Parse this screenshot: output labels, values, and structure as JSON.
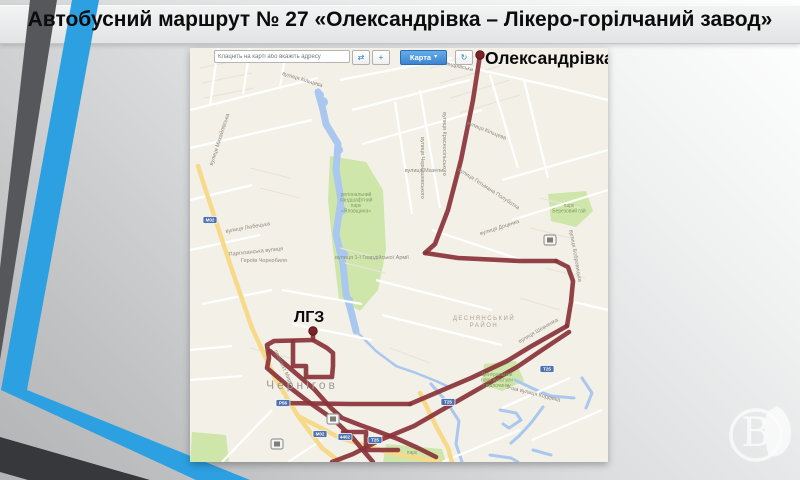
{
  "slide": {
    "title": "Автобусний маршрут № 27 «Олександрівка – Лікеро-горілчаний завод»",
    "watermark_letter": "В"
  },
  "toolbar": {
    "search_placeholder": "Клацніть на карті або вкажіть адресу",
    "map_button": "Карта",
    "icons": {
      "swap": "⇄",
      "pan": "+",
      "dropdown": "▾",
      "refresh": "↻"
    }
  },
  "route_labels": {
    "start": "Олександрівка",
    "end": "ЛГЗ"
  },
  "map": {
    "city": "Чернігов",
    "district": [
      "ДЕСНЯНСЬКИЙ",
      "РАЙОН"
    ],
    "colors": {
      "route": "#8a3338",
      "route_dot": "#7c2325",
      "water": "#a9c7ef",
      "park": "#cfe6ab",
      "road_major": "#f6da89",
      "map_bg": "#f3f0e8",
      "shield": "#5072b0",
      "street_label": "#8f8a80",
      "park_label": "#7f9f5f",
      "city_label": "#9b9b9b",
      "district_label": "#a9a39b",
      "white_road": "#ffffff",
      "minor_road": "#e9e4d7",
      "stripe_blue": "#2da0e2",
      "stripe_dark": "#55575a",
      "stripe_dark2": "#36383b"
    },
    "stripes": [
      {
        "fill": "#55575a",
        "pts": "30,0 57,0 0,360 0,268"
      },
      {
        "fill": "#2da0e2",
        "pts": "72,0 99,0 27,390 1,390"
      },
      {
        "fill": "#2da0e2",
        "pts": "1,390 27,390 250,480 196,480"
      },
      {
        "fill": "#36383b",
        "pts": "0,437 150,480 28,480 0,472"
      }
    ],
    "street_labels": [
      {
        "t": "вулиця Олександрівська",
        "x": 252,
        "y": 16,
        "r": 13
      },
      {
        "t": "вулиця Кільцева",
        "x": 112,
        "y": 33,
        "r": 17
      },
      {
        "t": "вулиця Кільцева",
        "x": 296,
        "y": 84,
        "r": 22
      },
      {
        "t": "вулиця Чернишевського",
        "x": 231,
        "y": 120,
        "r": 90
      },
      {
        "t": "вулиця Красносільського",
        "x": 253,
        "y": 96,
        "r": 90
      },
      {
        "t": "вулиця Мазепи",
        "x": 234,
        "y": 124,
        "r": 0
      },
      {
        "t": "вулиця Гетьмана Полуботка",
        "x": 298,
        "y": 142,
        "r": 33
      },
      {
        "t": "вулиця Бобровицька",
        "x": 384,
        "y": 208,
        "r": 80
      },
      {
        "t": "вулиця Доценка",
        "x": 310,
        "y": 181,
        "r": -18
      },
      {
        "t": "вулиця Шевченка",
        "x": 349,
        "y": 284,
        "r": -30
      },
      {
        "t": "1-ша вулиця Кордівка",
        "x": 343,
        "y": 347,
        "r": 14
      },
      {
        "t": "Партизанська вулиця",
        "x": 66,
        "y": 205,
        "r": -6
      },
      {
        "t": "Героїв Чорнобиля",
        "x": 74,
        "y": 214,
        "r": 0
      },
      {
        "t": "вулиця 1-ї Гвардійської Армії",
        "x": 182,
        "y": 211,
        "r": 0
      },
      {
        "t": "вулиця Михайлівська",
        "x": 31,
        "y": 92,
        "r": -72
      },
      {
        "t": "вулиця Любецька",
        "x": 58,
        "y": 181,
        "r": -10
      },
      {
        "t": "проспект Миру",
        "x": 92,
        "y": 320,
        "r": 65
      }
    ],
    "park_labels": [
      {
        "x": 166,
        "y": 148,
        "lines": [
          "регіональний",
          "ландшафтний",
          "парк",
          "«Яловщина»"
        ]
      },
      {
        "x": 379,
        "y": 159,
        "lines": [
          "парк",
          "Березовий гай"
        ]
      },
      {
        "x": 307,
        "y": 328,
        "lines": [
          "Центральний",
          "парк культури",
          "і відпочинку"
        ]
      },
      {
        "x": 222,
        "y": 406,
        "lines": [
          "парк"
        ]
      }
    ],
    "shields": [
      {
        "t": "М02",
        "x": 20,
        "y": 172
      },
      {
        "t": "Р56",
        "x": 93,
        "y": 355
      },
      {
        "t": "Т25",
        "x": 258,
        "y": 354
      },
      {
        "t": "М02",
        "x": 130,
        "y": 386
      },
      {
        "t": "4402",
        "x": 155,
        "y": 389
      },
      {
        "t": "Т25",
        "x": 185,
        "y": 392
      },
      {
        "t": "Т25",
        "x": 357,
        "y": 321
      }
    ],
    "bus_stops": [
      [
        360,
        192
      ],
      [
        143,
        371
      ],
      [
        87,
        396
      ]
    ],
    "endpoints": [
      [
        290,
        7
      ],
      [
        123,
        283
      ]
    ],
    "geometry": {
      "routes": [
        [
          290,
          7,
          283,
          52,
          271,
          112,
          258,
          162,
          245,
          196,
          235,
          205
        ],
        [
          235,
          205,
          268,
          210,
          330,
          213,
          366,
          213
        ],
        [
          366,
          213,
          378,
          219,
          383,
          233,
          381,
          254,
          377,
          278
        ],
        [
          377,
          278,
          340,
          299,
          317,
          313,
          281,
          330,
          248,
          344,
          220,
          356
        ],
        [
          220,
          356,
          160,
          356,
          93,
          355
        ],
        [
          123,
          284,
          123,
          292,
          84,
          293,
          77,
          297,
          79,
          310,
          77,
          320,
          98,
          338,
          120,
          355,
          143,
          371,
          162,
          389,
          172,
          401,
          183,
          414
        ],
        [
          80,
          303,
          102,
          322,
          124,
          341,
          141,
          360,
          152,
          370,
          170,
          377,
          192,
          385,
          208,
          391,
          228,
          400,
          246,
          409
        ],
        [
          379,
          284,
          352,
          302,
          327,
          319,
          292,
          339,
          257,
          359,
          224,
          378,
          190,
          392,
          163,
          406,
          142,
          414
        ],
        [
          123,
          292,
          137,
          300,
          143,
          305,
          143,
          318,
          142,
          329,
          116,
          329,
          116,
          318,
          103,
          318,
          103,
          293
        ],
        [
          153,
          384,
          176,
          384,
          176,
          402,
          208,
          402
        ]
      ],
      "yellow_roads": [
        [
          8,
          118,
          15,
          140,
          42,
          222,
          62,
          280,
          85,
          330,
          108,
          368,
          132,
          400,
          150,
          414
        ],
        [
          108,
          368,
          150,
          390,
          200,
          405,
          250,
          414
        ],
        [
          230,
          345,
          246,
          378,
          258,
          400,
          262,
          414
        ]
      ],
      "white_roads": [
        [
          28,
          0,
          20,
          58
        ],
        [
          60,
          0,
          53,
          46
        ],
        [
          96,
          2,
          90,
          40
        ],
        [
          0,
          62,
          128,
          30
        ],
        [
          0,
          100,
          122,
          72
        ],
        [
          150,
          32,
          262,
          10
        ],
        [
          162,
          62,
          280,
          32
        ],
        [
          172,
          96,
          292,
          62
        ],
        [
          230,
          42,
          250,
          160
        ],
        [
          205,
          54,
          222,
          166
        ],
        [
          300,
          27,
          328,
          120
        ],
        [
          334,
          32,
          358,
          130
        ],
        [
          312,
          132,
          418,
          102
        ],
        [
          322,
          172,
          418,
          142
        ],
        [
          0,
          152,
          62,
          137
        ],
        [
          0,
          202,
          70,
          187
        ],
        [
          12,
          256,
          82,
          242
        ],
        [
          92,
          242,
          172,
          256
        ],
        [
          102,
          276,
          182,
          292
        ],
        [
          186,
          232,
          302,
          262
        ],
        [
          192,
          267,
          312,
          297
        ],
        [
          242,
          182,
          332,
          212
        ],
        [
          384,
          254,
          418,
          262
        ],
        [
          312,
          360,
          380,
          330
        ],
        [
          342,
          392,
          412,
          362
        ],
        [
          252,
          414,
          330,
          382
        ],
        [
          0,
          302,
          42,
          298
        ],
        [
          0,
          332,
          52,
          328
        ],
        [
          32,
          414,
          82,
          362
        ],
        [
          98,
          414,
          132,
          392
        ],
        [
          215,
          2,
          290,
          22
        ],
        [
          290,
          22,
          370,
          40
        ],
        [
          370,
          40,
          418,
          52
        ],
        [
          290,
          7,
          271,
          112
        ]
      ],
      "minor_roads": [
        [
          240,
          20,
          300,
          5
        ],
        [
          250,
          35,
          310,
          18
        ],
        [
          260,
          50,
          320,
          32
        ],
        [
          270,
          65,
          330,
          47
        ],
        [
          10,
          20,
          60,
          10
        ],
        [
          12,
          35,
          62,
          25
        ],
        [
          14,
          50,
          64,
          40
        ],
        [
          150,
          200,
          190,
          210
        ],
        [
          155,
          215,
          195,
          225
        ],
        [
          60,
          300,
          100,
          310
        ],
        [
          200,
          300,
          240,
          315
        ],
        [
          350,
          150,
          390,
          160
        ],
        [
          340,
          180,
          380,
          190
        ],
        [
          355,
          220,
          395,
          230
        ],
        [
          330,
          250,
          370,
          262
        ],
        [
          60,
          120,
          100,
          130
        ],
        [
          70,
          140,
          110,
          150
        ]
      ],
      "water_lines": [
        {
          "w": 7,
          "p": [
            128,
            44,
            133,
            62,
            136,
            76,
            148,
            96,
            146,
            122,
            151,
            152,
            146,
            186,
            153,
            216,
            156,
            246,
            161,
            263,
            166,
            283
          ]
        },
        {
          "w": 2.5,
          "p": [
            166,
            283,
            186,
            303,
            206,
            318,
            226,
            325,
            246,
            333,
            259,
            339
          ]
        },
        {
          "w": 3,
          "p": [
            241,
            336,
            256,
            353,
            269,
            373,
            266,
            396,
            272,
            414
          ]
        },
        {
          "w": 3,
          "p": [
            325,
            332,
            346,
            342,
            361,
            348,
            384,
            350
          ]
        },
        {
          "w": 3,
          "p": [
            310,
            362,
            326,
            365,
            331,
            372,
            319,
            380,
            313,
            376
          ]
        },
        {
          "w": 3,
          "p": [
            353,
            359,
            341,
            375,
            329,
            388,
            321,
            395
          ]
        },
        {
          "w": 3,
          "p": [
            343,
            402,
            361,
            407
          ]
        },
        {
          "w": 3,
          "p": [
            300,
            407,
            321,
            410,
            328,
            414
          ]
        },
        {
          "w": 3,
          "p": [
            392,
            330,
            402,
            345,
            396,
            360
          ]
        }
      ],
      "water_dots": [
        [
          133,
          54,
          5
        ],
        [
          149,
          102,
          4
        ],
        [
          151,
          162,
          5
        ],
        [
          154,
          206,
          4
        ],
        [
          159,
          252,
          4
        ],
        [
          130,
          47,
          4
        ]
      ],
      "parks": [
        "140,108 176,114 193,142 196,202 188,242 170,263 149,251 143,202 138,152",
        "358,146 396,143 403,163 386,179 361,173",
        "294,316 326,313 334,333 312,343 292,336",
        "196,396 252,401 256,414 193,414",
        "2,384 36,387 39,414 0,414"
      ]
    }
  }
}
